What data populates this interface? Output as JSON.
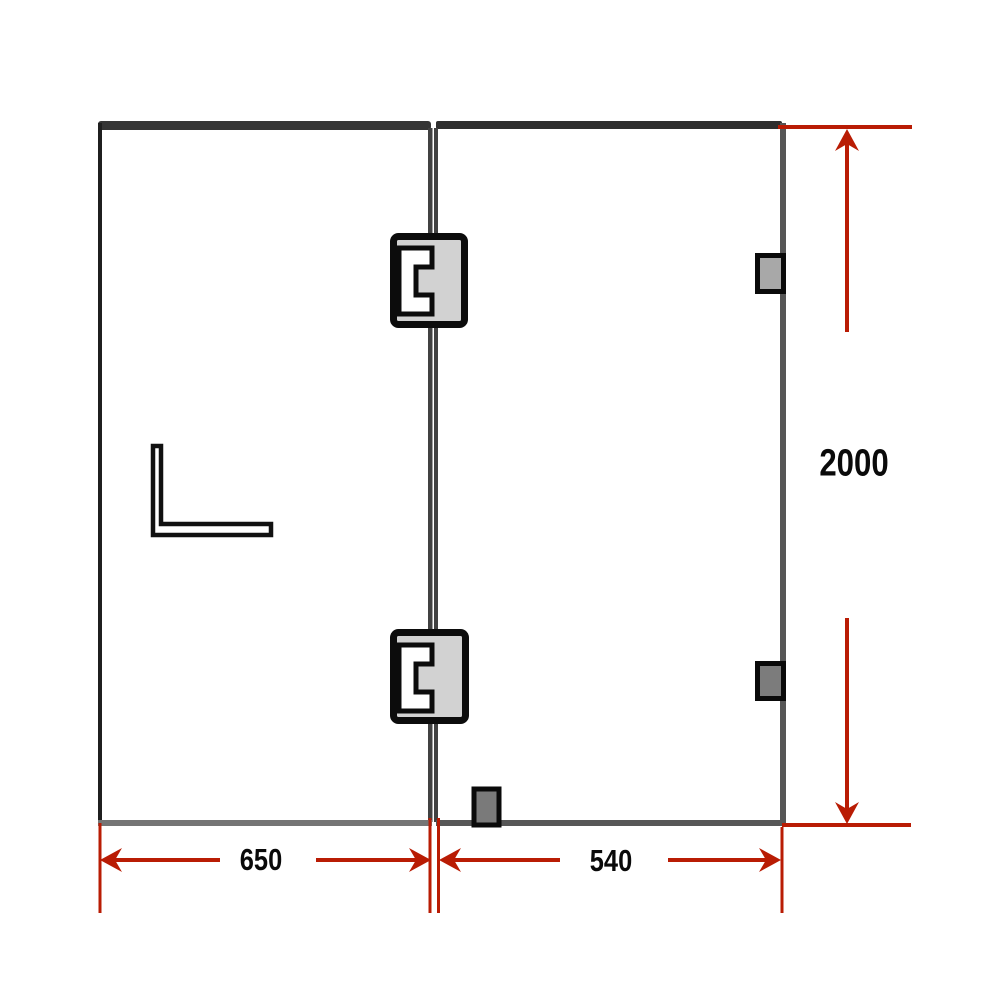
{
  "diagram": {
    "kind": "frameless-glass-shower-screen-dimension-drawing",
    "dimensions": {
      "left_panel_width": "650",
      "right_panel_width": "540",
      "panel_height": "2000"
    },
    "parts": {
      "panels": [
        "fixed-left-panel",
        "hinged-right-door-panel"
      ],
      "hinge_count": 2,
      "wall_bracket_count": 3,
      "handle": "l-shaped-corner-bracket"
    },
    "colors": {
      "dimension_red": "#b91c04",
      "frame_top_dark": "#353535",
      "frame_edge_dark": "#1f1f1f",
      "frame_bottom_gray": "#757575",
      "hinge_fill": "#d2d2d2",
      "hinge_border": "#0c0c0c",
      "bracket_fill_light": "#a8a8a8",
      "bracket_fill_dark": "#7c7c7c",
      "label_color": "#0a0a0a"
    }
  }
}
